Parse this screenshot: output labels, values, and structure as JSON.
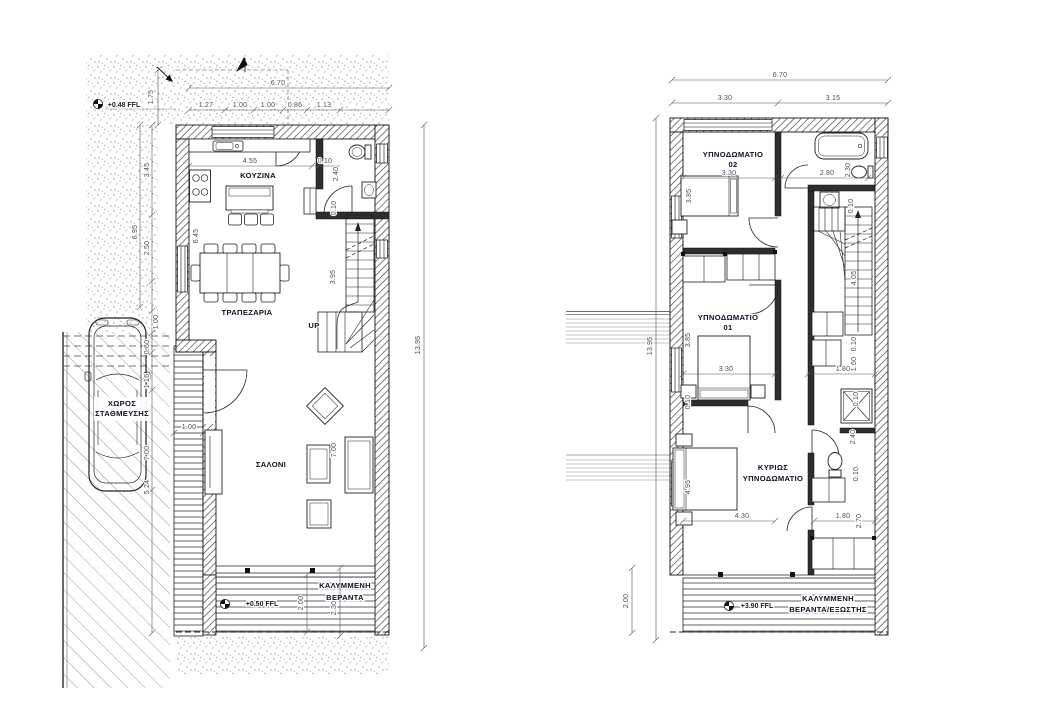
{
  "drawing_type": "architectural-floor-plans",
  "ground_floor": {
    "rooms": {
      "kitchen": "ΚΟΥΖΙΝΑ",
      "dining": "ΤΡΑΠΕΖΑΡΙΑ",
      "living": "ΣΑΛΟΝΙ",
      "parking_line1": "ΧΩΡΟΣ",
      "parking_line2": "ΣΤΑΘΜΕΥΣΗΣ",
      "veranda_line1": "ΚΑΛΥΜΜΕΝΗ",
      "veranda_line2": "ΒΕΡΑΝΤΑ"
    },
    "levels": {
      "site": "+0.48 FFL",
      "veranda": "+0.50 FFL"
    },
    "stairs_label": "UP",
    "dims": {
      "overall_width": "6.70",
      "top_segments": [
        "1.27",
        "1.00",
        "1.00",
        "0.86",
        "1.13"
      ],
      "setback": "1.75",
      "left_upper": "3.45",
      "left_overall": "6.95",
      "left_lower": "2.50",
      "overall_height": "13.95",
      "kitchen_width": "4.55",
      "wall_thickness": "0.10",
      "wc_depth": "2.40",
      "kitchen_depth": "6.45",
      "stair_run": "3.95",
      "entry_step": "1.00",
      "living_depth": "7.00",
      "parking_offsets": [
        "1.00",
        "0.60",
        "1.16"
      ],
      "parking_length": "7.00",
      "parking_remainder": "5.24",
      "veranda_depth": "2.00",
      "veranda_depth_overall": "2.30"
    }
  },
  "first_floor": {
    "rooms": {
      "bedroom2_line1": "ΥΠΝΟΔΩΜΑΤΙΟ",
      "bedroom2_line2": "02",
      "bedroom1_line1": "ΥΠΝΟΔΩΜΑΤΙΟ",
      "bedroom1_line2": "01",
      "master_line1": "ΚΥΡΙΩΣ",
      "master_line2": "ΥΠΝΟΔΩΜΑΤΙΟ",
      "veranda_line1": "ΚΑΛΥΜΜΕΝΗ",
      "veranda_line2": "ΒΕΡΑΝΤΑ/ΕΞΩΣΤΗΣ"
    },
    "levels": {
      "veranda": "+3.90 FFL"
    },
    "dims": {
      "overall_width": "6.70",
      "top_left": "3.30",
      "top_right": "3.15",
      "overall_height": "13.95",
      "veranda_depth": "2.00",
      "bedroom2_width": "3.30",
      "bedroom2_depth": "3.85",
      "bath_width": "2.80",
      "bath_depth": "2.30",
      "wall_thickness": "0.10",
      "stair_run": "4.05",
      "landing_width": "1.60",
      "hall_width": "1.80",
      "bedroom1_width": "3.30",
      "bedroom1_depth": "3.85",
      "master_depth": "4.95",
      "master_width": "4.30",
      "ensuite_depth": "2.40",
      "ensuite_width": "1.80",
      "closet_depth": "2.70"
    }
  },
  "colors": {
    "line": "#1c1c1c",
    "dim_text": "#4c4c5c",
    "hatch": "#3d3d3d",
    "stipple": "#a8a8a8",
    "paper": "#ffffff"
  }
}
